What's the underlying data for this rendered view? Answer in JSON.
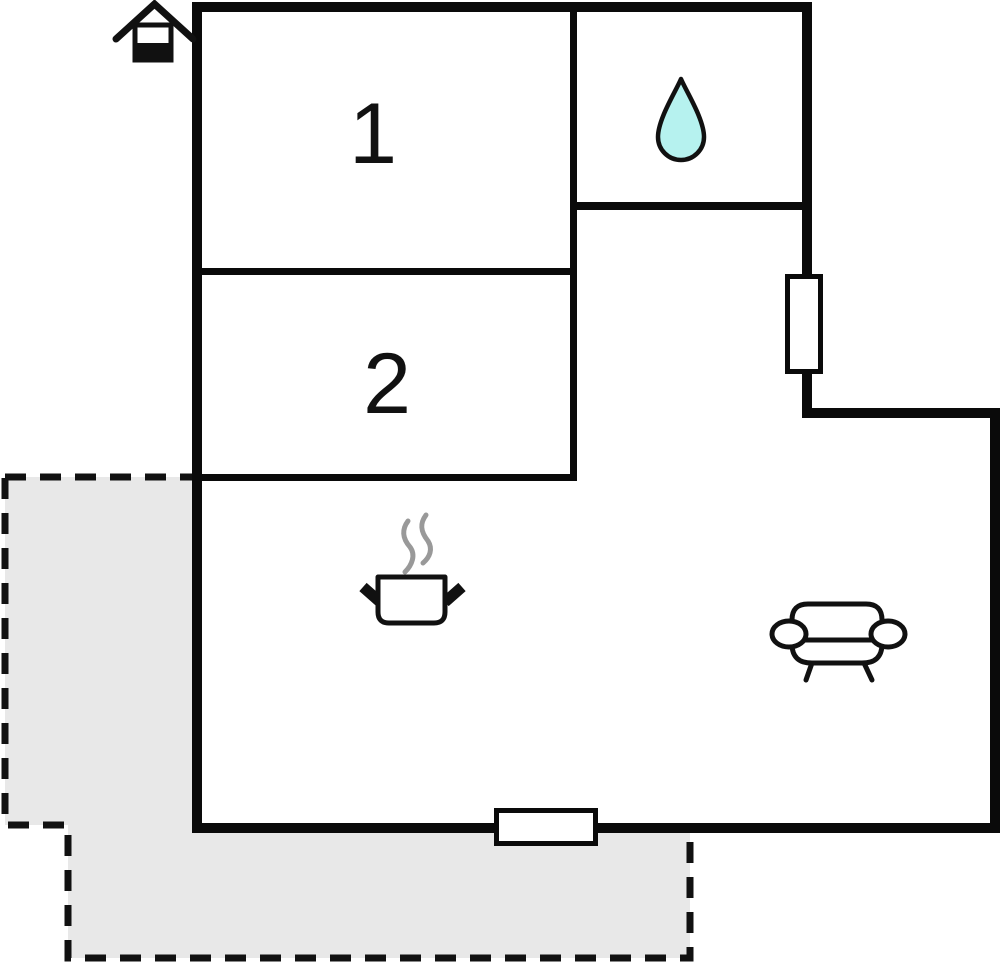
{
  "plan": {
    "type": "floor-plan",
    "rooms": [
      {
        "name": "bedroom-1",
        "label": "1"
      },
      {
        "name": "bedroom-2",
        "label": "2"
      }
    ],
    "icons": [
      {
        "name": "entrance-house-icon"
      },
      {
        "name": "water-drop-icon"
      },
      {
        "name": "cooking-pot-icon"
      },
      {
        "name": "steam-icon"
      },
      {
        "name": "sofa-icon"
      }
    ],
    "features": [
      {
        "name": "window-right"
      },
      {
        "name": "window-bottom"
      },
      {
        "name": "terrace-area"
      }
    ],
    "colors": {
      "wall": "#0a0a0a",
      "background": "#ffffff",
      "terrace_fill": "#e8e8e8",
      "terrace_border": "#111111",
      "water_drop_fill": "#b6f2ef",
      "steam": "#999999",
      "icon_stroke": "#111111"
    }
  }
}
